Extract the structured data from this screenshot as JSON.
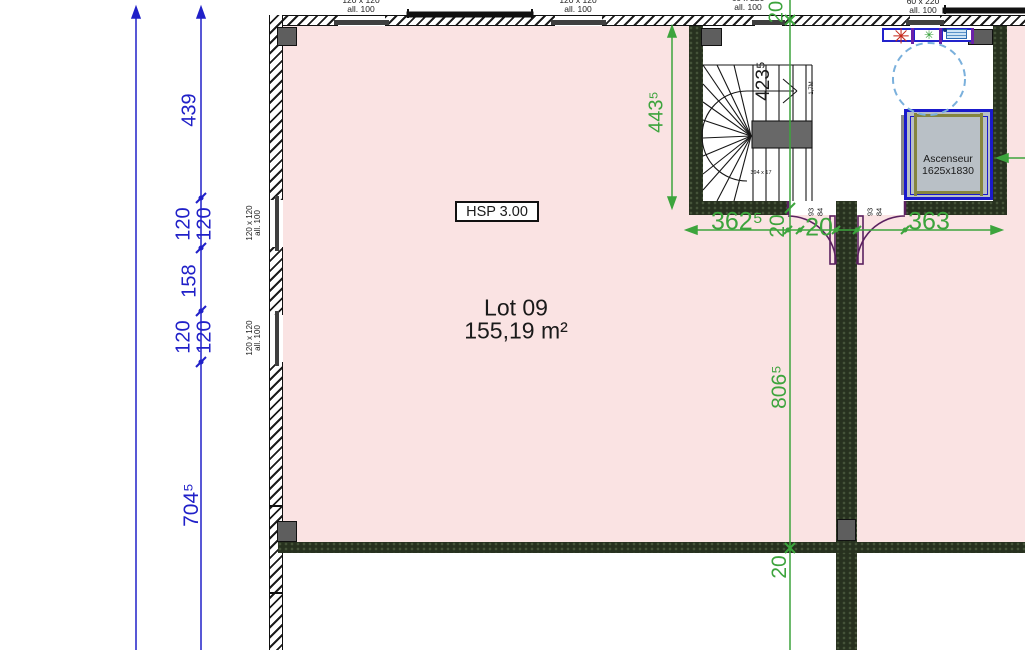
{
  "room": {
    "hsp_label": "HSP 3.00",
    "lot_name": "Lot 09",
    "lot_area": "155,19 m²"
  },
  "elevator": {
    "name": "Ascenseur",
    "dimensions": "1625x1830"
  },
  "left_dimension_chain": {
    "values": [
      "439",
      "120",
      "120",
      "158",
      "120",
      "120",
      "704⁵"
    ]
  },
  "window_labels": {
    "size_120": "120 x 120",
    "size_60": "60 x 220",
    "allege": "all. 100"
  },
  "stairwell": {
    "width_dim": "423⁵",
    "height_dim": "443⁵",
    "tread_note": "394 x 17",
    "headroom_note": "1,7M"
  },
  "bottom_dimension_chain": {
    "seg_362": "362⁵",
    "wall_20_left": "20",
    "wall_20_right": "20",
    "seg_363": "363"
  },
  "vertical_dimension_chain": {
    "wall_top_20": "20",
    "room_height": "806⁵",
    "wall_bottom_20": "20"
  },
  "door_dimensions": {
    "left_93": "93",
    "left_84": "84",
    "right_93": "93",
    "right_84": "84"
  },
  "symbols": {
    "red_marker": "✳",
    "green_marker": "✳"
  },
  "colors": {
    "room_pink": "#fae3e3",
    "dimension_blue": "#2020c8",
    "dimension_green": "#3da43d",
    "wall_dark": "#27311f",
    "elevator_blue": "#1a1acc",
    "door_purple": "#6b21a8"
  }
}
